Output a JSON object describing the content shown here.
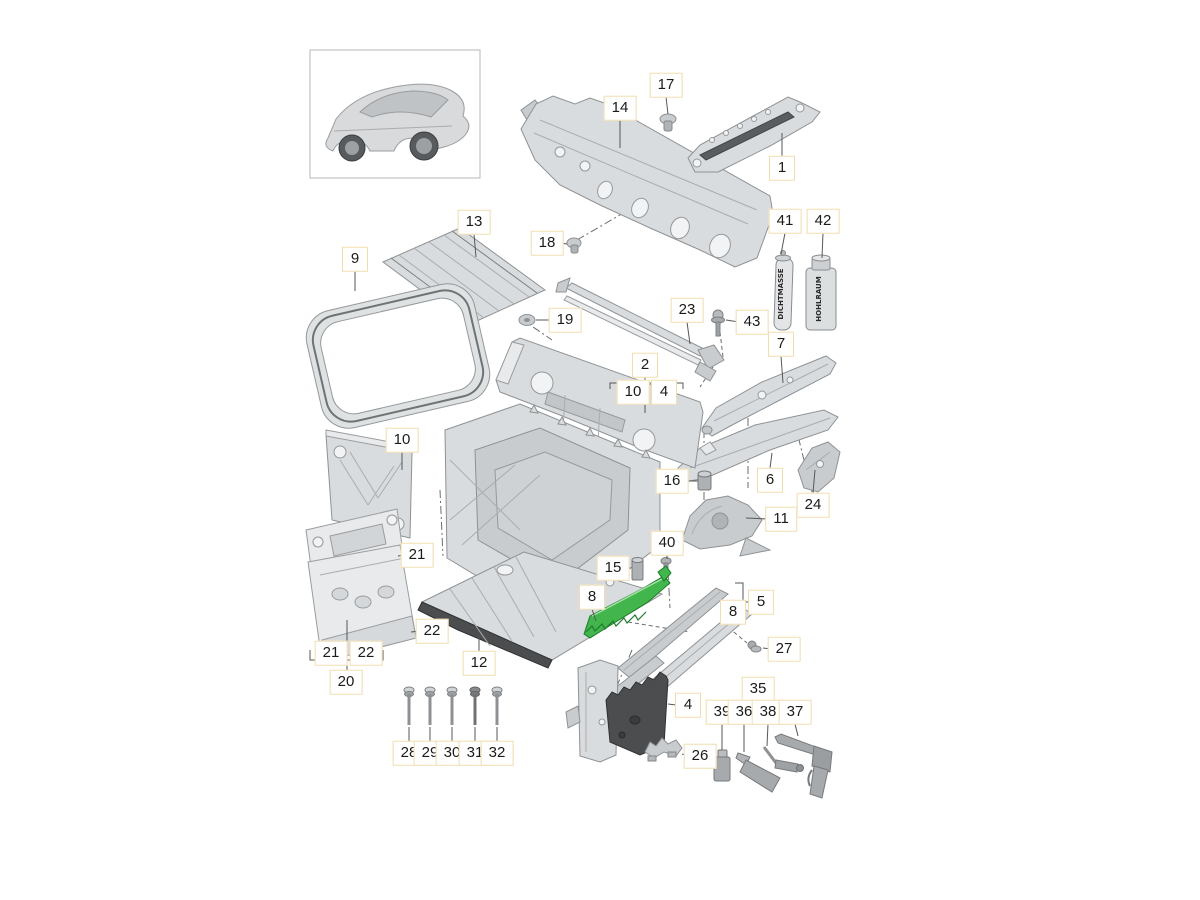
{
  "diagram": {
    "type": "exploded-parts-diagram",
    "colors": {
      "highlight": "#42b54c",
      "highlight_edge": "#1e7c2c",
      "label_border": "#f2ddb0",
      "part_fill": "#d9dcde",
      "dark_part": "#4b4d4f"
    },
    "cans": {
      "can_41_text": "DICHTMASSE",
      "can_42_text": "HOHLRAUM"
    },
    "groups": [
      {
        "parent": "2",
        "children": [
          "10",
          "4"
        ]
      },
      {
        "parent": "20",
        "children": [
          "21",
          "22"
        ]
      },
      {
        "parent": "5",
        "children": [
          "8"
        ]
      },
      {
        "parent": "35",
        "children": [
          "39",
          "36",
          "38",
          "37"
        ]
      }
    ],
    "callouts": [
      {
        "label": "17"
      },
      {
        "label": "14"
      },
      {
        "label": "1"
      },
      {
        "label": "18"
      },
      {
        "label": "41"
      },
      {
        "label": "42"
      },
      {
        "label": "13"
      },
      {
        "label": "9"
      },
      {
        "label": "19"
      },
      {
        "label": "23"
      },
      {
        "label": "43"
      },
      {
        "label": "7"
      },
      {
        "label": "2"
      },
      {
        "label": "10"
      },
      {
        "label": "4"
      },
      {
        "label": "10"
      },
      {
        "label": "16"
      },
      {
        "label": "6"
      },
      {
        "label": "24"
      },
      {
        "label": "11"
      },
      {
        "label": "21"
      },
      {
        "label": "15"
      },
      {
        "label": "40"
      },
      {
        "label": "8"
      },
      {
        "label": "8"
      },
      {
        "label": "5"
      },
      {
        "label": "27"
      },
      {
        "label": "22"
      },
      {
        "label": "12"
      },
      {
        "label": "21"
      },
      {
        "label": "22"
      },
      {
        "label": "20"
      },
      {
        "label": "4"
      },
      {
        "label": "26"
      },
      {
        "label": "35"
      },
      {
        "label": "39"
      },
      {
        "label": "36"
      },
      {
        "label": "38"
      },
      {
        "label": "37"
      },
      {
        "label": "28"
      },
      {
        "label": "29"
      },
      {
        "label": "30"
      },
      {
        "label": "31"
      },
      {
        "label": "32"
      }
    ]
  }
}
